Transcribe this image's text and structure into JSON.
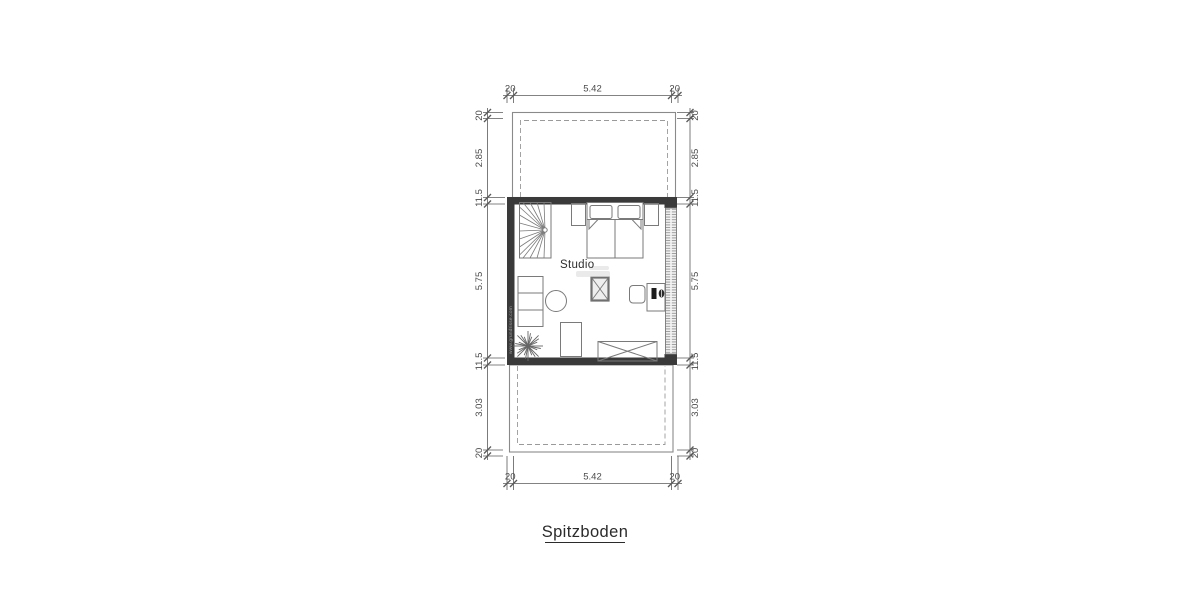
{
  "plan": {
    "title": "Spitzboden",
    "room_label": "Studio",
    "watermark": "www.grundrisse.com",
    "dims": {
      "top": [
        "20",
        "5.42",
        "20"
      ],
      "bottom": [
        "20",
        "5.42",
        "20"
      ],
      "left": [
        "20",
        "2.85",
        "11.5",
        "5.75",
        "11.5",
        "3.03",
        "20"
      ],
      "right": [
        "20",
        "2.85",
        "11.5",
        "5.75",
        "11.5",
        "3.03",
        "20"
      ]
    },
    "colors": {
      "wall": "#3a3a3a",
      "outline": "#8a8a8a",
      "furniture": "#7a7a7a",
      "dimension": "#555555",
      "text": "#2b2b2b"
    },
    "icons": {
      "spiral-staircase": "fan-of-treads",
      "double-bed": "two-mattresses-with-pillows",
      "chimney": "crossed-square",
      "shelf": "divided-rectangle",
      "round-table": "circle",
      "plant": "starburst",
      "armchair": "rectangle",
      "sideboard": "crossed-rectangle",
      "desk": "rectangle-with-laptop-and-mouse",
      "desk-chair": "rounded-square"
    }
  }
}
